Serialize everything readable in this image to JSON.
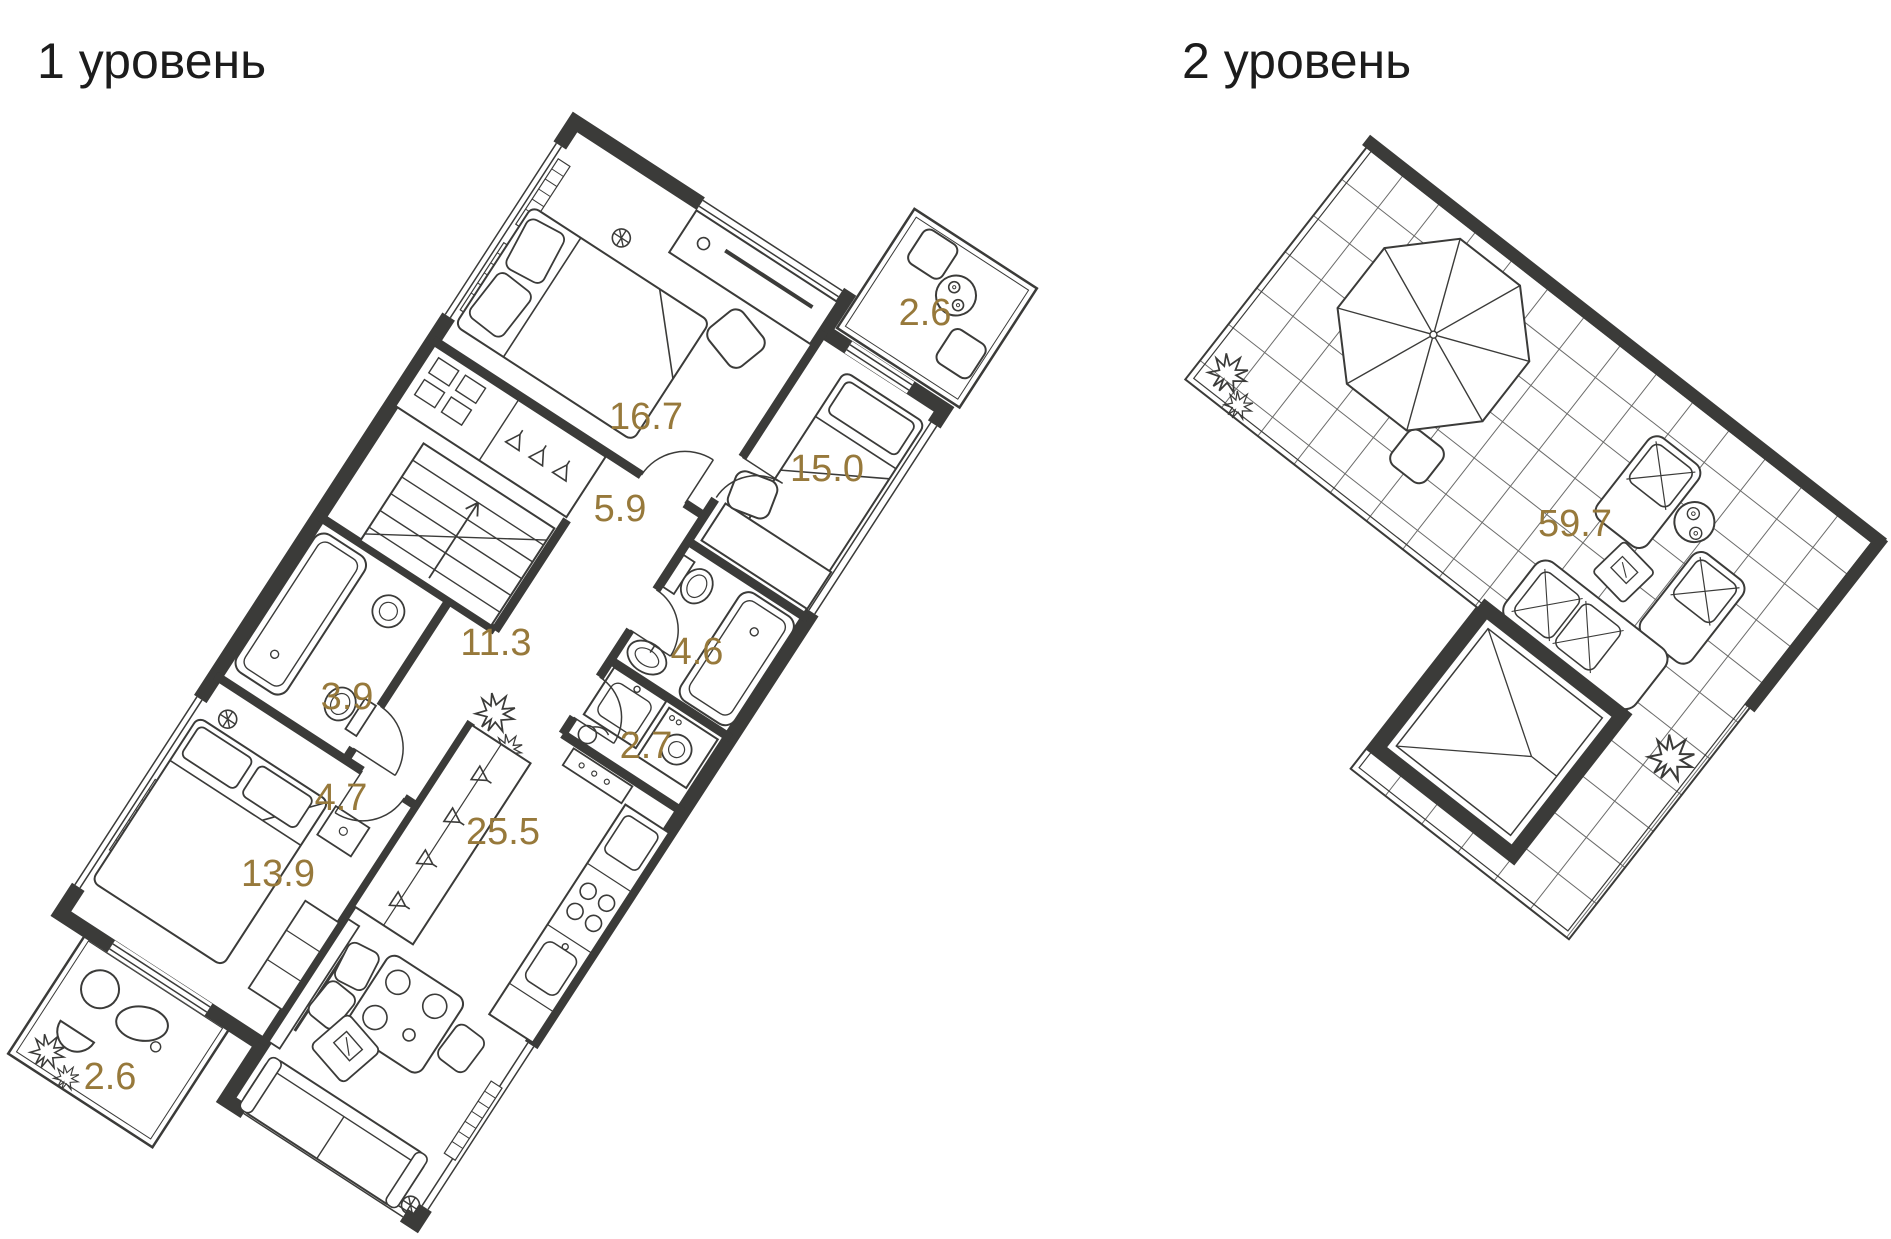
{
  "colors": {
    "wall": "#3B3B39",
    "area_label_gold": "#97793B",
    "title_text": "#1C1C1C",
    "background": "#FFFFFF"
  },
  "level1": {
    "title": "1 уровень",
    "areas": {
      "bedroom_top": "16.7",
      "bedroom_right": "15.0",
      "balcony_top": "2.6",
      "hall": "5.9",
      "bathroom_right": "4.6",
      "corridor": "11.3",
      "laundry": "2.7",
      "bathroom_left": "3.9",
      "hallway": "4.7",
      "living_kitchen": "25.5",
      "bedroom_bottom": "13.9",
      "balcony_bottom": "2.6"
    }
  },
  "level2": {
    "title": "2 уровень",
    "areas": {
      "terrace": "59.7"
    }
  }
}
